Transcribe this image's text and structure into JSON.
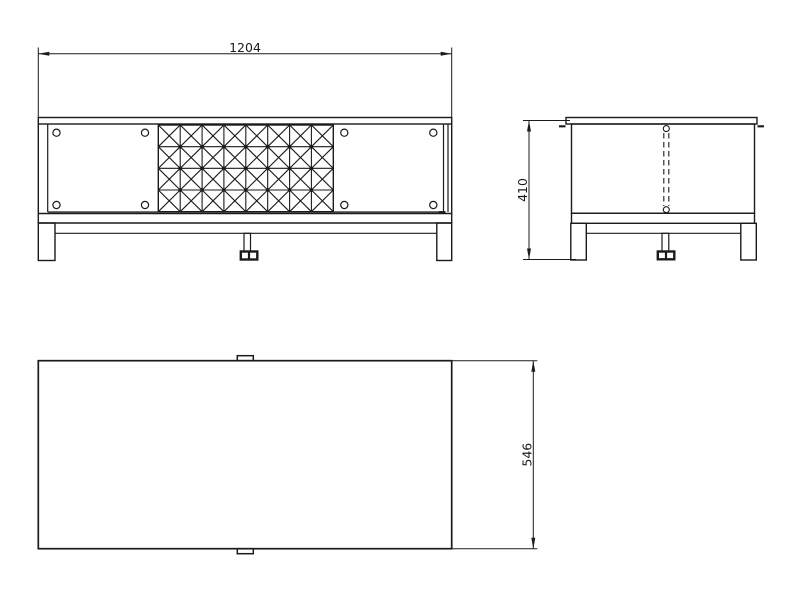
{
  "colors": {
    "line": "#1b1b1b",
    "background": "#ffffff"
  },
  "views": {
    "front_view": {
      "dimension_width": "1204",
      "lattice": {
        "rows": 4,
        "cols": 8
      },
      "door_holes": 8
    },
    "side_view": {
      "dimension_height": "410"
    },
    "top_view": {
      "dimension_depth": "546"
    }
  }
}
